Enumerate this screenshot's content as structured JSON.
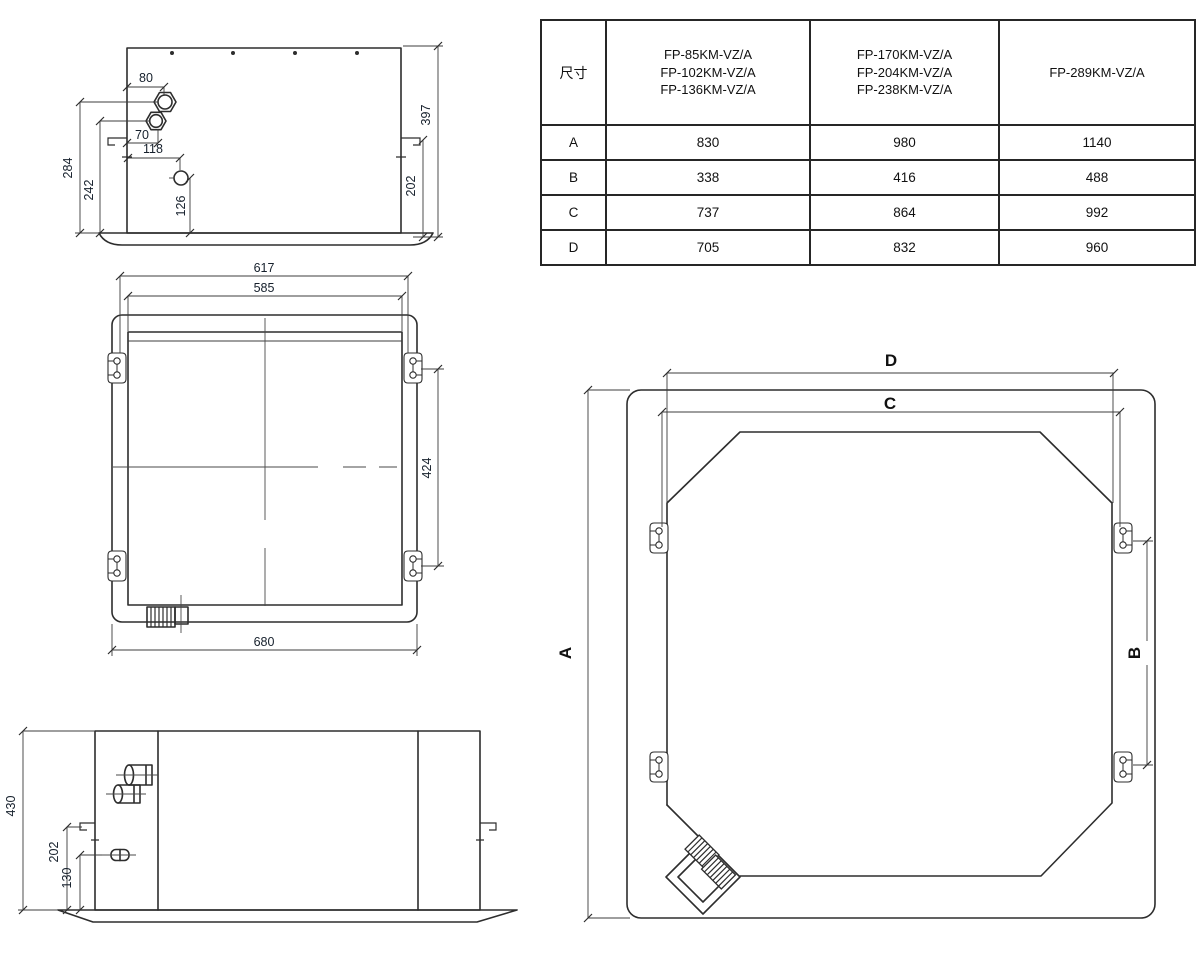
{
  "colors": {
    "line": "#2d2d2d",
    "text": "#16202c",
    "background": "#ffffff"
  },
  "table": {
    "corner_label": "尺寸",
    "model_columns": [
      [
        "FP-85KM-VZ/A",
        "FP-102KM-VZ/A",
        "FP-136KM-VZ/A"
      ],
      [
        "FP-170KM-VZ/A",
        "FP-204KM-VZ/A",
        "FP-238KM-VZ/A"
      ],
      [
        "FP-289KM-VZ/A"
      ]
    ],
    "rows": [
      {
        "label": "A",
        "values": [
          "830",
          "980",
          "1140"
        ]
      },
      {
        "label": "B",
        "values": [
          "338",
          "416",
          "488"
        ]
      },
      {
        "label": "C",
        "values": [
          "737",
          "864",
          "992"
        ]
      },
      {
        "label": "D",
        "values": [
          "705",
          "832",
          "960"
        ]
      }
    ]
  },
  "side_view": {
    "d80": "80",
    "d70": "70",
    "d118": "118",
    "d126": "126",
    "d242": "242",
    "d284": "284",
    "d397": "397",
    "d202": "202"
  },
  "plan_view": {
    "d617": "617",
    "d585": "585",
    "d424": "424",
    "d680": "680"
  },
  "front_view": {
    "d430": "430",
    "d202": "202",
    "d130": "130"
  },
  "panel_view": {
    "A": "A",
    "B": "B",
    "C": "C",
    "D": "D"
  }
}
